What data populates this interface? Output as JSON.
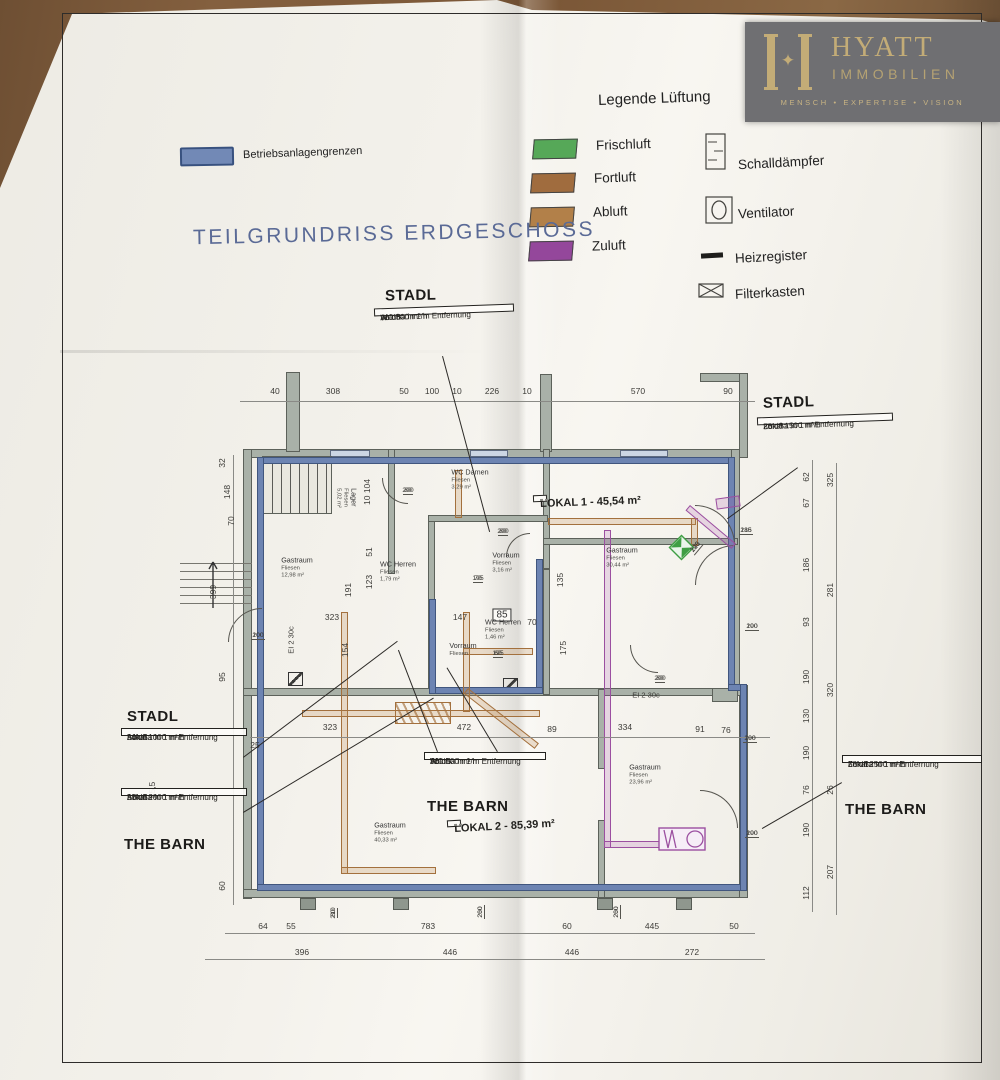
{
  "logo": {
    "monogram": "✦",
    "name": "HYATT",
    "name2": "IMMOBILIEN",
    "tagline": "MENSCH • EXPERTISE • VISION"
  },
  "legend": {
    "title": "Legende Lüftung",
    "ducts": [
      {
        "label": "Frischluft",
        "color": "#56a858"
      },
      {
        "label": "Fortluft",
        "color": "#a06c3e"
      },
      {
        "label": "Abluft",
        "color": "#b28049"
      },
      {
        "label": "Zuluft",
        "color": "#94479b"
      }
    ],
    "symbols": [
      {
        "icon": "silencer-icon",
        "label": "Schalldämpfer"
      },
      {
        "icon": "fan-icon",
        "label": "Ventilator"
      },
      {
        "icon": "heating-register-icon",
        "label": "Heizregister"
      },
      {
        "icon": "filter-box-icon",
        "label": "Filterkasten"
      }
    ]
  },
  "boundary": {
    "label": "Betriebsanlagengrenzen",
    "color": "#7289b6"
  },
  "drawing_title": "TEILGRUNDRISS ERDGESCHOSS",
  "callouts": [
    {
      "heading": "STADL",
      "lines": [
        "Abluft:",
        "WC 500 m³/h",
        "36 dBa in 1 m Entfernung"
      ]
    },
    {
      "heading": "STADL",
      "lines": [
        "Zuluft:",
        "Lokal 1500 m³/h",
        "35 dBa in 1 m Entfernung"
      ]
    },
    {
      "heading": "STADL",
      "lines": [
        "Abluft:",
        "Lokal 1000 m³/h",
        "34 dBa in 1 m Entfernung"
      ]
    },
    {
      "heading": "THE BARN",
      "lines": [
        "Abluft:",
        "Lokal 2000 m³/h",
        "37 dBa in 1 m Entfernung"
      ]
    },
    {
      "heading": "THE BARN",
      "lines": [
        "Abluft:",
        "WC 500 m³/h",
        "36 dBa in 1 m Entfernung"
      ]
    },
    {
      "heading": "THE BARN",
      "lines": [
        "Zuluft:",
        "Lokal 2500 m³/h",
        "38 dBa in 1 m Entfernung"
      ]
    }
  ],
  "plan": {
    "dims": {
      "top": [
        "40",
        "308",
        "50",
        "100",
        "10",
        "226",
        "10",
        "570",
        "90"
      ],
      "mid": [
        "25",
        "323",
        "472",
        "89",
        "334",
        "91",
        "76"
      ],
      "bottom_upper": [
        "64",
        "55",
        "783",
        "60",
        "445",
        "50"
      ],
      "bottom_lower": [
        "396",
        "446",
        "446",
        "272"
      ],
      "left": [
        "32",
        "148",
        "70",
        "399",
        "95",
        "55,5",
        "60"
      ],
      "right_inner": [
        "62",
        "67",
        "186",
        "93",
        "190",
        "130",
        "190",
        "76",
        "190",
        "112"
      ],
      "right_outer": [
        "325",
        "281",
        "320",
        "26",
        "207"
      ],
      "interior": [
        "51",
        "123",
        "191",
        "154",
        "323",
        "147",
        "70",
        "175",
        "135",
        "10 104"
      ]
    },
    "door_sizes": [
      "80/200",
      "80/200",
      "80/200",
      "100/200",
      "70/195",
      "60/195",
      "185/216",
      "190/200",
      "190/200",
      "190/200",
      "120/245",
      "80/210",
      "260/200",
      "260/200"
    ],
    "boxed": "85",
    "fire_rating": "EI 2 30c",
    "rooms": [
      {
        "name": "Lager",
        "floor": "Fliesen",
        "area": "5,02 m²"
      },
      {
        "name": "WC Damen",
        "floor": "Fliesen",
        "area": "3,29 m²"
      },
      {
        "name": "Vorraum",
        "floor": "Fliesen",
        "area": "3,16 m²"
      },
      {
        "name": "Gastraum",
        "floor": "Fliesen",
        "area": "12,98 m²"
      },
      {
        "name": "WC Herren",
        "floor": "Fliesen",
        "area": "1,79 m²"
      },
      {
        "name": "WC Herren",
        "floor": "Fliesen",
        "area": "1,46 m²"
      },
      {
        "name": "Vorraum",
        "floor": "Fliesen",
        "area": ""
      },
      {
        "name": "Gastraum",
        "floor": "Fliesen",
        "area": "30,44 m²"
      },
      {
        "name": "Gastraum",
        "floor": "Fliesen",
        "area": "23,96 m²"
      },
      {
        "name": "Gastraum",
        "floor": "Fliesen",
        "area": "40,33 m²"
      }
    ],
    "zones": [
      {
        "label": "LOKAL 1 - 45,54 m²"
      },
      {
        "label": "LOKAL 2 - 85,39 m²"
      }
    ]
  }
}
